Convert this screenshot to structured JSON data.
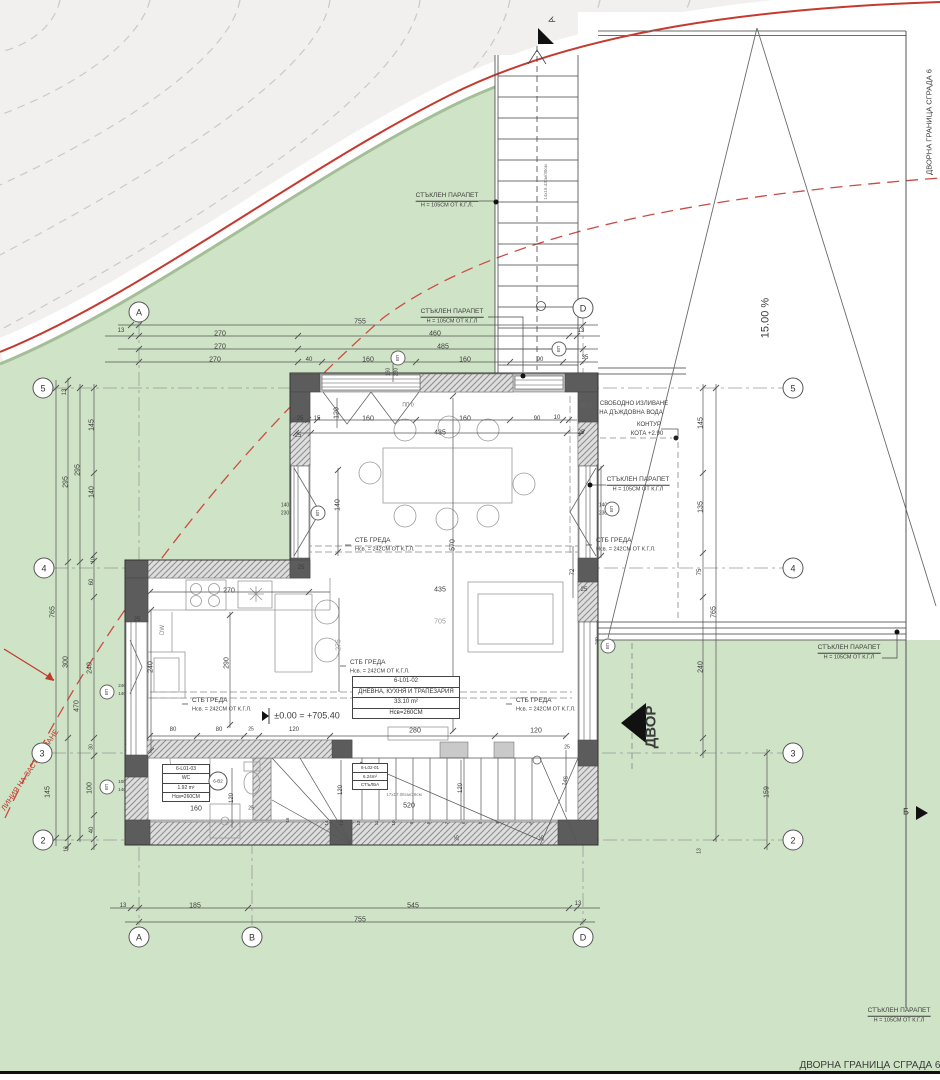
{
  "colors": {
    "terrain_gray": "#f1f0ee",
    "contour_line": "#c9c9c7",
    "site_green": "#cfe3c6",
    "site_green_edge": "#a4bf98",
    "boundary_red": "#c5392e",
    "building_line_red": "#cc4b44",
    "wall_dark": "#5c5c5c",
    "wall_light": "#c9c9c9",
    "line": "#555555",
    "text": "#3c3c3c"
  },
  "rooms": {
    "living": {
      "id": "6-L01-02",
      "name": "ДНЕВНА, КУХНЯ И ТРАПЕЗАРИЯ",
      "area": "33.10 m²",
      "height": "Нсв=260СМ"
    },
    "wc": {
      "id": "6-L01-03",
      "name": "WC",
      "area": "1.92 m²",
      "height": "Нсв=260СМ"
    },
    "stairs": {
      "id": "6-L02-01",
      "area": "6.24m²",
      "name": "СТЪЛБА"
    }
  },
  "markers": {
    "b2": "6-В2",
    "vp": "ВП"
  },
  "grid_markers": [
    {
      "x": 139,
      "y": 312,
      "t": "A"
    },
    {
      "x": 583,
      "y": 308,
      "t": "D"
    },
    {
      "x": 139,
      "y": 937,
      "t": "A"
    },
    {
      "x": 252,
      "y": 937,
      "t": "B"
    },
    {
      "x": 583,
      "y": 937,
      "t": "D"
    },
    {
      "x": 43,
      "y": 388,
      "t": "5"
    },
    {
      "x": 44,
      "y": 568,
      "t": "4"
    },
    {
      "x": 42,
      "y": 753,
      "t": "3"
    },
    {
      "x": 43,
      "y": 840,
      "t": "2"
    },
    {
      "x": 793,
      "y": 388,
      "t": "5"
    },
    {
      "x": 793,
      "y": 568,
      "t": "4"
    },
    {
      "x": 793,
      "y": 753,
      "t": "3"
    },
    {
      "x": 793,
      "y": 840,
      "t": "2"
    }
  ],
  "vp_markers": [
    {
      "x": 398,
      "y": 358
    },
    {
      "x": 559,
      "y": 349
    },
    {
      "x": 318,
      "y": 513
    },
    {
      "x": 612,
      "y": 509
    },
    {
      "x": 107,
      "y": 692
    },
    {
      "x": 107,
      "y": 787
    },
    {
      "x": 608,
      "y": 646
    }
  ],
  "labels": [
    {
      "x": 360,
      "y": 322,
      "t": "755"
    },
    {
      "x": 121,
      "y": 331,
      "t": "13",
      "fs": 6
    },
    {
      "x": 220,
      "y": 334,
      "t": "270"
    },
    {
      "x": 435,
      "y": 334,
      "t": "460"
    },
    {
      "x": 581,
      "y": 331,
      "t": "13",
      "fs": 6
    },
    {
      "x": 220,
      "y": 347,
      "t": "270"
    },
    {
      "x": 443,
      "y": 347,
      "t": "485"
    },
    {
      "x": 215,
      "y": 360,
      "t": "270"
    },
    {
      "x": 309,
      "y": 360,
      "t": "40",
      "fs": 6
    },
    {
      "x": 368,
      "y": 360,
      "t": "160"
    },
    {
      "x": 465,
      "y": 360,
      "t": "160"
    },
    {
      "x": 540,
      "y": 360,
      "t": "90",
      "fs": 6
    },
    {
      "x": 585,
      "y": 358,
      "t": "35",
      "fs": 6
    },
    {
      "x": 389,
      "y": 372,
      "t": "160",
      "fs": 5,
      "r": -90
    },
    {
      "x": 397,
      "y": 372,
      "t": "230",
      "fs": 5,
      "r": -90
    },
    {
      "x": 447,
      "y": 197,
      "t": "СТЪКЛЕН ПАРАПЕТ",
      "fs": 6.5,
      "u": 1
    },
    {
      "x": 447,
      "y": 206,
      "t": "Н = 105СМ ОТ К.Г.Л.",
      "fs": 5.5
    },
    {
      "x": 452,
      "y": 313,
      "t": "СТЪКЛЕН ПАРАПЕТ",
      "fs": 6.5,
      "u": 1
    },
    {
      "x": 452,
      "y": 322,
      "t": "Н = 105СМ ОТ К.Г.Л",
      "fs": 5.5
    },
    {
      "x": 638,
      "y": 481,
      "t": "СТЪКЛЕН ПАРАПЕТ",
      "fs": 6.5,
      "u": 1
    },
    {
      "x": 638,
      "y": 490,
      "t": "Н = 105СМ ОТ К.Г.Л",
      "fs": 5.5
    },
    {
      "x": 849,
      "y": 649,
      "t": "СТЪКЛЕН ПАРАПЕТ",
      "fs": 6.5,
      "u": 1
    },
    {
      "x": 849,
      "y": 658,
      "t": "Н = 105СМ ОТ К.Г.Л",
      "fs": 5.5
    },
    {
      "x": 899,
      "y": 1012,
      "t": "СТЪКЛЕН ПАРАПЕТ",
      "fs": 6.5,
      "u": 1
    },
    {
      "x": 899,
      "y": 1021,
      "t": "Н = 105СМ ОТ К.Г.Л",
      "fs": 5.5
    },
    {
      "x": 929,
      "y": 122,
      "t": "ДВОРНА ГРАНИЦА СГРАДА 6",
      "fs": 7.5,
      "r": -90
    },
    {
      "x": 870,
      "y": 1066,
      "t": "ДВОРНА ГРАНИЦА СГРАДА 6",
      "fs": 10
    },
    {
      "x": 634,
      "y": 404,
      "t": "СВОБОДНО ИЗЛИВАНЕ",
      "fs": 6
    },
    {
      "x": 631,
      "y": 413,
      "t": "НА ДЪЖДОВНА ВОДА",
      "fs": 6
    },
    {
      "x": 649,
      "y": 425,
      "t": "КОНТУР",
      "fs": 6
    },
    {
      "x": 647,
      "y": 434,
      "t": "КОТА +2.90",
      "fs": 6
    },
    {
      "x": 766,
      "y": 318,
      "t": "15.00 %",
      "fs": 11,
      "r": -90
    },
    {
      "x": 651,
      "y": 727,
      "t": "ДВОР",
      "fs": 15,
      "r": -90,
      "b": 1
    },
    {
      "x": 906,
      "y": 812,
      "t": "Б",
      "fs": 9
    },
    {
      "x": 552,
      "y": 20,
      "t": "А",
      "fs": 9,
      "r": -115
    },
    {
      "x": 30,
      "y": 770,
      "t": "ЛИНИЯ НА ЗАСТРОЯВАНЕ",
      "fs": 7.5,
      "r": -56,
      "c": "#c0392b"
    },
    {
      "x": 300,
      "y": 419,
      "t": "25",
      "fs": 6
    },
    {
      "x": 317,
      "y": 419,
      "t": "15",
      "fs": 6
    },
    {
      "x": 337,
      "y": 413,
      "t": "120",
      "r": -90
    },
    {
      "x": 368,
      "y": 419,
      "t": "160"
    },
    {
      "x": 465,
      "y": 419,
      "t": "160"
    },
    {
      "x": 537,
      "y": 419,
      "t": "90",
      "fs": 6
    },
    {
      "x": 557,
      "y": 418,
      "t": "10",
      "fs": 6
    },
    {
      "x": 408,
      "y": 406,
      "t": "ПП 0",
      "fs": 5,
      "c": "#666"
    },
    {
      "x": 586,
      "y": 407,
      "t": "ПП 0",
      "fs": 5,
      "c": "#666"
    },
    {
      "x": 440,
      "y": 433,
      "t": "435"
    },
    {
      "x": 298,
      "y": 436,
      "t": "25",
      "fs": 6
    },
    {
      "x": 581,
      "y": 433,
      "t": "25",
      "fs": 6
    },
    {
      "x": 285,
      "y": 506,
      "t": "140",
      "fs": 5
    },
    {
      "x": 285,
      "y": 514,
      "t": "230",
      "fs": 5
    },
    {
      "x": 603,
      "y": 506,
      "t": "140",
      "fs": 5
    },
    {
      "x": 603,
      "y": 514,
      "t": "230",
      "fs": 5
    },
    {
      "x": 338,
      "y": 505,
      "t": "140",
      "r": -90
    },
    {
      "x": 453,
      "y": 545,
      "t": "570",
      "r": -90
    },
    {
      "x": 573,
      "y": 572,
      "t": "72",
      "fs": 6,
      "r": -90
    },
    {
      "x": 355,
      "y": 541,
      "t": "СТБ ГРЕДА",
      "fs": 6.5,
      "a": "l"
    },
    {
      "x": 355,
      "y": 550,
      "t": "Нсв. = 242СМ ОТ К.Г.Л.",
      "fs": 5.5,
      "a": "l"
    },
    {
      "x": 596,
      "y": 541,
      "t": "СТБ ГРЕДА",
      "fs": 6.5,
      "a": "l"
    },
    {
      "x": 596,
      "y": 550,
      "t": "Нсв. = 242СМ ОТ К.Г.Л.",
      "fs": 5.5,
      "a": "l"
    },
    {
      "x": 350,
      "y": 663,
      "t": "СТБ ГРЕДА",
      "fs": 6.5,
      "a": "l"
    },
    {
      "x": 350,
      "y": 672,
      "t": "Нсв. = 242СМ ОТ К.Г.Л.",
      "fs": 5.5,
      "a": "l"
    },
    {
      "x": 516,
      "y": 701,
      "t": "СТБ ГРЕДА",
      "fs": 6.5,
      "a": "l"
    },
    {
      "x": 516,
      "y": 710,
      "t": "Нсв. = 242СМ ОТ К.Г.Л.",
      "fs": 5.5,
      "a": "l"
    },
    {
      "x": 192,
      "y": 701,
      "t": "СТБ ГРЕДА",
      "fs": 6.5,
      "a": "l"
    },
    {
      "x": 192,
      "y": 710,
      "t": "Нсв. = 242СМ ОТ К.Г.Л.",
      "fs": 5.5,
      "a": "l"
    },
    {
      "x": 229,
      "y": 591,
      "t": "270"
    },
    {
      "x": 227,
      "y": 663,
      "t": "290",
      "r": -90
    },
    {
      "x": 151,
      "y": 667,
      "t": "240",
      "r": -90
    },
    {
      "x": 339,
      "y": 645,
      "t": "275",
      "r": -90,
      "c": "#999"
    },
    {
      "x": 440,
      "y": 590,
      "t": "435"
    },
    {
      "x": 440,
      "y": 622,
      "t": "705",
      "c": "#999"
    },
    {
      "x": 163,
      "y": 630,
      "t": "DW",
      "fs": 6,
      "r": -90,
      "c": "#888"
    },
    {
      "x": 307,
      "y": 716,
      "t": "±0.00 = +705.40",
      "fs": 9
    },
    {
      "x": 173,
      "y": 730,
      "t": "80",
      "fs": 6
    },
    {
      "x": 219,
      "y": 730,
      "t": "80",
      "fs": 6
    },
    {
      "x": 251,
      "y": 730,
      "t": "25",
      "fs": 5
    },
    {
      "x": 294,
      "y": 730,
      "t": "120",
      "fs": 6
    },
    {
      "x": 415,
      "y": 731,
      "t": "280"
    },
    {
      "x": 536,
      "y": 731,
      "t": "120"
    },
    {
      "x": 196,
      "y": 809,
      "t": "160"
    },
    {
      "x": 232,
      "y": 798,
      "t": "120",
      "fs": 6,
      "r": -90
    },
    {
      "x": 251,
      "y": 809,
      "t": "25",
      "fs": 5
    },
    {
      "x": 341,
      "y": 790,
      "t": "120",
      "fs": 6,
      "r": -90
    },
    {
      "x": 461,
      "y": 788,
      "t": "120",
      "fs": 6,
      "r": -90
    },
    {
      "x": 566,
      "y": 781,
      "t": "145",
      "fs": 6,
      "r": -78
    },
    {
      "x": 409,
      "y": 806,
      "t": "520"
    },
    {
      "x": 404,
      "y": 795,
      "t": "17x17.06см/29см",
      "fs": 4.5,
      "c": "#777"
    },
    {
      "x": 327,
      "y": 823,
      "t": "14",
      "fs": 4.5,
      "r": -90
    },
    {
      "x": 342,
      "y": 823,
      "t": "13",
      "fs": 4.5,
      "r": -90
    },
    {
      "x": 359,
      "y": 823,
      "t": "12",
      "fs": 4.5,
      "r": -90
    },
    {
      "x": 377,
      "y": 823,
      "t": "11",
      "fs": 4.5,
      "r": -90
    },
    {
      "x": 394,
      "y": 823,
      "t": "10",
      "fs": 4.5,
      "r": -90
    },
    {
      "x": 412,
      "y": 823,
      "t": "9",
      "fs": 4.5,
      "r": -90
    },
    {
      "x": 429,
      "y": 823,
      "t": "8",
      "fs": 4.5,
      "r": -90
    },
    {
      "x": 447,
      "y": 823,
      "t": "7",
      "fs": 4.5,
      "r": -90
    },
    {
      "x": 464,
      "y": 823,
      "t": "6",
      "fs": 4.5,
      "r": -90
    },
    {
      "x": 481,
      "y": 823,
      "t": "5",
      "fs": 4.5,
      "r": -90
    },
    {
      "x": 498,
      "y": 823,
      "t": "4",
      "fs": 4.5,
      "r": -90
    },
    {
      "x": 531,
      "y": 824,
      "t": "3",
      "fs": 4.5,
      "r": -45
    },
    {
      "x": 288,
      "y": 820,
      "t": "16",
      "fs": 4.5,
      "r": -90
    },
    {
      "x": 137,
      "y": 620,
      "t": "25",
      "fs": 6
    },
    {
      "x": 301,
      "y": 568,
      "t": "25",
      "fs": 6
    },
    {
      "x": 584,
      "y": 590,
      "t": "25",
      "fs": 6
    },
    {
      "x": 567,
      "y": 748,
      "t": "25",
      "fs": 5
    },
    {
      "x": 458,
      "y": 838,
      "t": "25",
      "fs": 5,
      "r": -90
    },
    {
      "x": 543,
      "y": 838,
      "t": "25",
      "fs": 5,
      "r": -90
    },
    {
      "x": 65,
      "y": 392,
      "t": "13",
      "fs": 6,
      "r": -90
    },
    {
      "x": 92,
      "y": 425,
      "t": "145",
      "r": -90
    },
    {
      "x": 78,
      "y": 470,
      "t": "295",
      "r": -90
    },
    {
      "x": 66,
      "y": 482,
      "t": "295",
      "r": -90
    },
    {
      "x": 92,
      "y": 492,
      "t": "140",
      "r": -90
    },
    {
      "x": 94,
      "y": 560,
      "t": "10",
      "fs": 5,
      "r": -90
    },
    {
      "x": 92,
      "y": 582,
      "t": "60",
      "fs": 6,
      "r": -90
    },
    {
      "x": 53,
      "y": 612,
      "t": "765",
      "r": -90
    },
    {
      "x": 66,
      "y": 662,
      "t": "300",
      "r": -90
    },
    {
      "x": 90,
      "y": 668,
      "t": "240",
      "r": -90
    },
    {
      "x": 77,
      "y": 706,
      "t": "470",
      "r": -90
    },
    {
      "x": 92,
      "y": 747,
      "t": "30",
      "fs": 5,
      "r": -90
    },
    {
      "x": 48,
      "y": 792,
      "t": "145",
      "r": -90
    },
    {
      "x": 90,
      "y": 788,
      "t": "100",
      "r": -90
    },
    {
      "x": 92,
      "y": 830,
      "t": "40",
      "fs": 6,
      "r": -90
    },
    {
      "x": 67,
      "y": 849,
      "t": "13",
      "fs": 5,
      "r": -90
    },
    {
      "x": 122,
      "y": 686,
      "t": "240",
      "fs": 4.5
    },
    {
      "x": 122,
      "y": 694,
      "t": "140",
      "fs": 4.5
    },
    {
      "x": 122,
      "y": 782,
      "t": "100",
      "fs": 4.5
    },
    {
      "x": 122,
      "y": 790,
      "t": "140",
      "fs": 4.5
    },
    {
      "x": 597,
      "y": 641,
      "t": "240",
      "fs": 4.5,
      "r": -90
    },
    {
      "x": 701,
      "y": 423,
      "t": "145",
      "r": -90
    },
    {
      "x": 701,
      "y": 507,
      "t": "135",
      "r": -90
    },
    {
      "x": 700,
      "y": 572,
      "t": "75",
      "fs": 6,
      "r": -90
    },
    {
      "x": 714,
      "y": 612,
      "t": "765",
      "r": -90
    },
    {
      "x": 701,
      "y": 667,
      "t": "240",
      "r": -90
    },
    {
      "x": 767,
      "y": 792,
      "t": "159",
      "r": -90
    },
    {
      "x": 700,
      "y": 851,
      "t": "13",
      "fs": 5,
      "r": -90
    },
    {
      "x": 123,
      "y": 906,
      "t": "13",
      "fs": 6
    },
    {
      "x": 195,
      "y": 906,
      "t": "185"
    },
    {
      "x": 413,
      "y": 906,
      "t": "545"
    },
    {
      "x": 578,
      "y": 904,
      "t": "13",
      "fs": 6
    },
    {
      "x": 360,
      "y": 920,
      "t": "755"
    },
    {
      "x": 546,
      "y": 182,
      "t": "14x16.43см/30см",
      "fs": 4.5,
      "r": -90,
      "c": "#777"
    }
  ]
}
